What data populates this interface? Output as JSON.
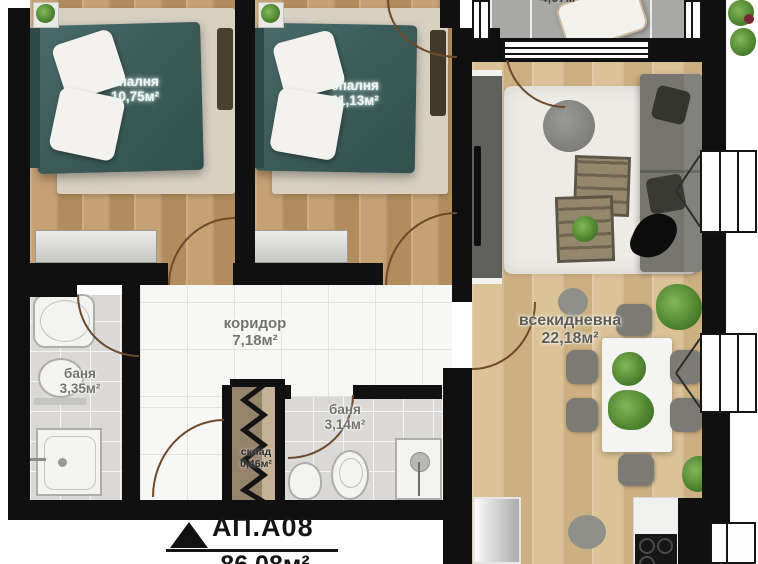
{
  "plan": {
    "apartment": {
      "id": "АП.А08",
      "area": "86,08м²"
    },
    "rooms": {
      "bedroom1": {
        "name": "спалня",
        "area": "10,75м²"
      },
      "bedroom2": {
        "name": "спалня",
        "area": "11,13м²"
      },
      "corridor": {
        "name": "коридор",
        "area": "7,18м²"
      },
      "bathroom1": {
        "name": "баня",
        "area": "3,35м²"
      },
      "bathroom2": {
        "name": "баня",
        "area": "3,14м²"
      },
      "storage": {
        "name": "склад",
        "area": "0,46м²"
      },
      "living": {
        "name": "всекидневна",
        "area": "22,18м²"
      },
      "terrace": {
        "area": "4,07м²"
      }
    },
    "colors": {
      "wall": "#101010",
      "bedroom_wood": "#bd9867",
      "living_wood": "#d3b687",
      "corridor_marble": "#f7f7f5",
      "bath_tile": "#dad9d7",
      "terrace_tile": "#a8a8a6",
      "duvet_teal": "#3a5957",
      "bed_rug": "#d8d1c2",
      "living_rug": "#edebe6",
      "sofa_grey": "#76766f",
      "plant_green": "#4f8430",
      "door_arc": "#6d4a28"
    }
  }
}
